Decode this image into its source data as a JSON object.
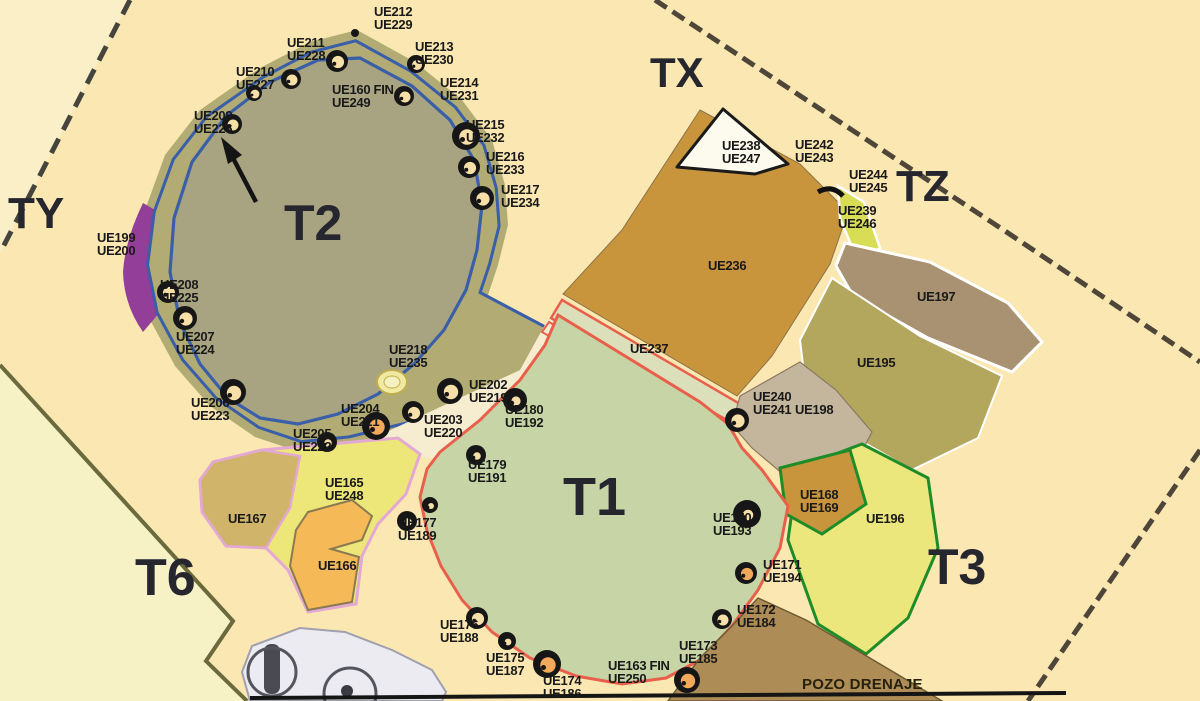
{
  "map": {
    "type": "archaeological-excavation-plan",
    "zone_labels": [
      {
        "id": "TX",
        "label": "TX",
        "x": 650,
        "y": 52,
        "size": 42
      },
      {
        "id": "TY",
        "label": "TY",
        "x": 8,
        "y": 192,
        "size": 44
      },
      {
        "id": "TZ",
        "label": "TZ",
        "x": 896,
        "y": 165,
        "size": 44
      },
      {
        "id": "T2",
        "label": "T2",
        "x": 284,
        "y": 198,
        "size": 50
      },
      {
        "id": "T1",
        "label": "T1",
        "x": 563,
        "y": 470,
        "size": 54
      },
      {
        "id": "T3",
        "label": "T3",
        "x": 928,
        "y": 542,
        "size": 50
      },
      {
        "id": "T6",
        "label": "T6",
        "x": 135,
        "y": 552,
        "size": 52
      }
    ],
    "ue_labels": [
      {
        "lines": [
          "UE212",
          "UE229"
        ],
        "x": 374,
        "y": 6
      },
      {
        "lines": [
          "UE211",
          "UE228"
        ],
        "x": 287,
        "y": 37
      },
      {
        "lines": [
          "UE213",
          "UE230"
        ],
        "x": 415,
        "y": 41
      },
      {
        "lines": [
          "UE210",
          "UE227"
        ],
        "x": 236,
        "y": 66
      },
      {
        "lines": [
          "UE160 FIN",
          "UE249"
        ],
        "x": 332,
        "y": 84
      },
      {
        "lines": [
          "UE214",
          "UE231"
        ],
        "x": 440,
        "y": 77
      },
      {
        "lines": [
          "UE209",
          "UE226"
        ],
        "x": 194,
        "y": 110
      },
      {
        "lines": [
          "UE215",
          "UE232"
        ],
        "x": 466,
        "y": 119
      },
      {
        "lines": [
          "UE216",
          "UE233"
        ],
        "x": 486,
        "y": 151
      },
      {
        "lines": [
          "UE217",
          "UE234"
        ],
        "x": 501,
        "y": 184
      },
      {
        "lines": [
          "UE199",
          "UE200"
        ],
        "x": 97,
        "y": 232
      },
      {
        "lines": [
          "UE208",
          "UE225"
        ],
        "x": 160,
        "y": 279
      },
      {
        "lines": [
          "UE207",
          "UE224"
        ],
        "x": 176,
        "y": 331
      },
      {
        "lines": [
          "UE218",
          "UE235"
        ],
        "x": 389,
        "y": 344
      },
      {
        "lines": [
          "UE202",
          "UE219"
        ],
        "x": 469,
        "y": 379
      },
      {
        "lines": [
          "UE206",
          "UE223"
        ],
        "x": 191,
        "y": 397
      },
      {
        "lines": [
          "UE204",
          "UE221"
        ],
        "x": 341,
        "y": 403
      },
      {
        "lines": [
          "UE180",
          "UE192"
        ],
        "x": 505,
        "y": 404
      },
      {
        "lines": [
          "UE203",
          "UE220"
        ],
        "x": 424,
        "y": 414
      },
      {
        "lines": [
          "UE205",
          "UE222"
        ],
        "x": 293,
        "y": 428
      },
      {
        "lines": [
          "UE238",
          "UE247"
        ],
        "x": 722,
        "y": 140
      },
      {
        "lines": [
          "UE242",
          "UE243"
        ],
        "x": 795,
        "y": 139
      },
      {
        "lines": [
          "UE244",
          "UE245"
        ],
        "x": 849,
        "y": 169
      },
      {
        "lines": [
          "UE239",
          "UE246"
        ],
        "x": 838,
        "y": 205
      },
      {
        "lines": [
          "UE236"
        ],
        "x": 708,
        "y": 260
      },
      {
        "lines": [
          "UE197"
        ],
        "x": 917,
        "y": 291
      },
      {
        "lines": [
          "UE237"
        ],
        "x": 630,
        "y": 343
      },
      {
        "lines": [
          "UE195"
        ],
        "x": 857,
        "y": 357
      },
      {
        "lines": [
          "UE240",
          "UE241"
        ],
        "x": 753,
        "y": 391
      },
      {
        "lines": [
          "UE198"
        ],
        "x": 795,
        "y": 404
      },
      {
        "lines": [
          "UE179",
          "UE191"
        ],
        "x": 468,
        "y": 459
      },
      {
        "lines": [
          "UE168",
          "UE169"
        ],
        "x": 800,
        "y": 489
      },
      {
        "lines": [
          "UE165",
          "UE248"
        ],
        "x": 325,
        "y": 477
      },
      {
        "lines": [
          "UE167"
        ],
        "x": 228,
        "y": 513
      },
      {
        "lines": [
          "UE170",
          "UE193"
        ],
        "x": 713,
        "y": 512
      },
      {
        "lines": [
          "UE196"
        ],
        "x": 866,
        "y": 513
      },
      {
        "lines": [
          "UE177",
          "UE189"
        ],
        "x": 398,
        "y": 517
      },
      {
        "lines": [
          "UE171",
          "UE194"
        ],
        "x": 763,
        "y": 559
      },
      {
        "lines": [
          "UE166"
        ],
        "x": 318,
        "y": 560
      },
      {
        "lines": [
          "UE172",
          "UE184"
        ],
        "x": 737,
        "y": 604
      },
      {
        "lines": [
          "UE176",
          "UE188"
        ],
        "x": 440,
        "y": 619
      },
      {
        "lines": [
          "UE173",
          "UE185"
        ],
        "x": 679,
        "y": 640
      },
      {
        "lines": [
          "UE175",
          "UE187"
        ],
        "x": 486,
        "y": 652
      },
      {
        "lines": [
          "UE163 FIN",
          "UE250"
        ],
        "x": 608,
        "y": 660
      },
      {
        "lines": [
          "UE174",
          "UE186"
        ],
        "x": 543,
        "y": 675
      },
      {
        "lines": [
          "POZO DRENAJE"
        ],
        "x": 802,
        "y": 679,
        "cls": "pozo"
      }
    ],
    "colors": {
      "background": "#FBE7B1",
      "outside_area": "#F6F2C6",
      "t2_interior": "#A8A482",
      "t2_band": "#B2AC74",
      "ring_outline_blue": "#3A5FA8",
      "t1_fill": "#C7D4A6",
      "t1_outline_red": "#E8604B",
      "ue236_fill": "#C9953C",
      "ue237_fill": "#DCE0BA",
      "ue195_fill": "#B3A75E",
      "ue196_fill": "#ECE77D",
      "green_outline": "#1E8C28",
      "ue197_fill": "#A89272",
      "ue198_fill": "#C3B69C",
      "ue165_fill": "#EDE678",
      "ue166_fill": "#F5B957",
      "ue167_fill": "#CFB46A",
      "pink_outline": "#E3A9D4",
      "ue199_purple": "#933E98",
      "pozo_band": "#AE8C55",
      "tz_wedge": "#D9DD55",
      "posthole_center": "#F7DFA8",
      "posthole_center_orange": "#F2A95C"
    }
  }
}
